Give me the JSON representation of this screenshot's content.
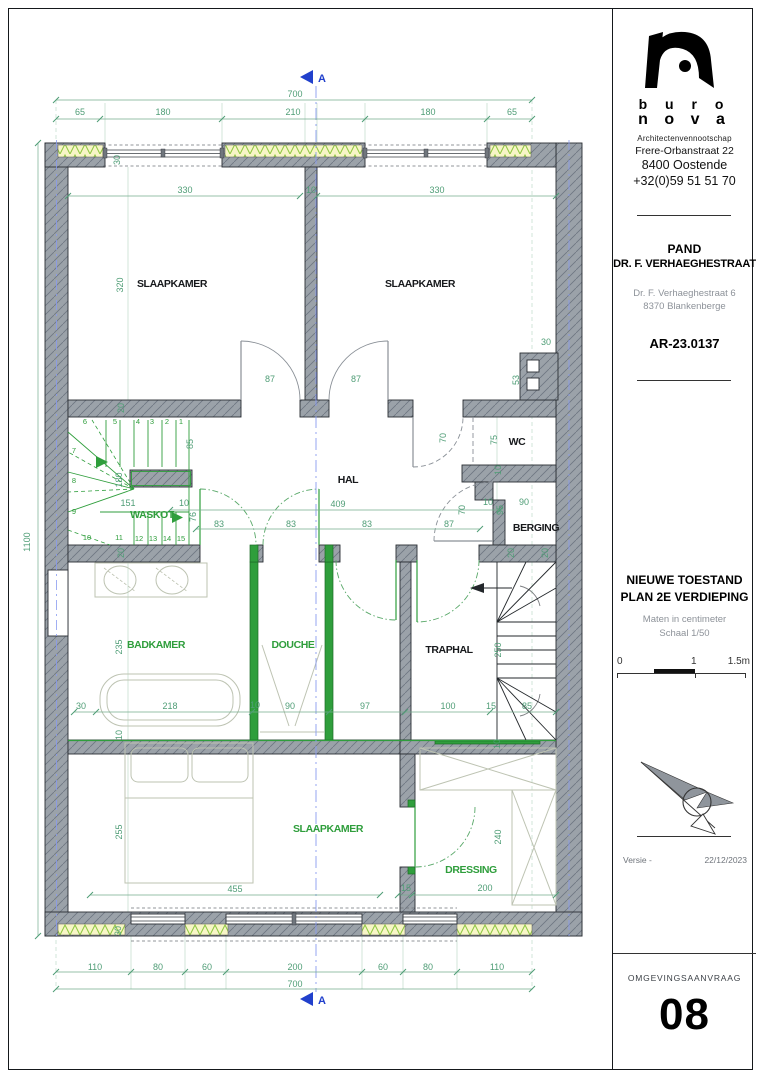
{
  "firm": {
    "logo_word1": "b u r o",
    "logo_word2": "n o v a",
    "descriptor": "Architectenvennootschap",
    "street": "Frere-Orbanstraat 22",
    "city": "8400 Oostende",
    "phone": "+32(0)59 51 51 70"
  },
  "project": {
    "name_line1": "PAND",
    "name_line2": "DR. F. VERHAEGHESTRAAT",
    "address_line1": "Dr. F. Verhaeghestraat 6",
    "address_line2": "8370 Blankenberge",
    "reference": "AR-23.0137"
  },
  "drawing": {
    "title_line1": "NIEUWE TOESTAND",
    "title_line2": "PLAN 2E VERDIEPING",
    "units_note": "Maten in centimeter",
    "scale_note": "Schaal 1/50",
    "scale_bar": {
      "start": "0",
      "mid": "1",
      "end": "1.5m"
    },
    "section_label": "A"
  },
  "sheet": {
    "version_label": "Versie -",
    "version_date": "22/12/2023",
    "doc_type": "OMGEVINGSAANVRAAG",
    "number": "08"
  },
  "colors": {
    "wall_gray": "#9ba2a9",
    "new_work_green": "#2f9e3c",
    "dimension_green": "#4f9d76",
    "insulation_yellow": "#f7f5c6",
    "insulation_zigzag": "#8cc63f",
    "section_blue": "#2140cc",
    "party_wall_blue": "#8a9cf0"
  },
  "plan": {
    "rooms": [
      {
        "label": "SLAAPKAMER",
        "x": 172,
        "y": 287,
        "color": "black"
      },
      {
        "label": "SLAAPKAMER",
        "x": 420,
        "y": 287,
        "color": "black"
      },
      {
        "label": "HAL",
        "x": 348,
        "y": 483,
        "color": "black"
      },
      {
        "label": "WC",
        "x": 517,
        "y": 445,
        "color": "black"
      },
      {
        "label": "BERGING",
        "x": 536,
        "y": 531,
        "color": "black"
      },
      {
        "label": "WASKOT",
        "x": 152,
        "y": 518,
        "color": "green"
      },
      {
        "label": "BADKAMER",
        "x": 156,
        "y": 648,
        "color": "green"
      },
      {
        "label": "DOUCHE",
        "x": 293,
        "y": 648,
        "color": "green"
      },
      {
        "label": "TRAPHAL",
        "x": 449,
        "y": 653,
        "color": "black"
      },
      {
        "label": "SLAAPKAMER",
        "x": 328,
        "y": 832,
        "color": "green"
      },
      {
        "label": "DRESSING",
        "x": 471,
        "y": 873,
        "color": "green"
      }
    ],
    "dims": [
      {
        "t": "700",
        "x": 295,
        "y": 97
      },
      {
        "t": "65",
        "x": 80,
        "y": 115
      },
      {
        "t": "180",
        "x": 163,
        "y": 115
      },
      {
        "t": "210",
        "x": 293,
        "y": 115
      },
      {
        "t": "180",
        "x": 428,
        "y": 115
      },
      {
        "t": "65",
        "x": 512,
        "y": 115
      },
      {
        "t": "330",
        "x": 185,
        "y": 193
      },
      {
        "t": "10",
        "x": 311,
        "y": 193
      },
      {
        "t": "330",
        "x": 437,
        "y": 193
      },
      {
        "t": "30",
        "x": 120,
        "y": 160,
        "r": 1
      },
      {
        "t": "320",
        "x": 123,
        "y": 285,
        "r": 1
      },
      {
        "t": "20",
        "x": 124,
        "y": 408,
        "r": 1
      },
      {
        "t": "30",
        "x": 546,
        "y": 345
      },
      {
        "t": "53",
        "x": 519,
        "y": 380,
        "r": 1
      },
      {
        "t": "87",
        "x": 270,
        "y": 382
      },
      {
        "t": "87",
        "x": 356,
        "y": 382
      },
      {
        "t": "85",
        "x": 193,
        "y": 444,
        "r": 1
      },
      {
        "t": "180",
        "x": 122,
        "y": 480,
        "r": 1
      },
      {
        "t": "151",
        "x": 128,
        "y": 506
      },
      {
        "t": "10",
        "x": 184,
        "y": 506
      },
      {
        "t": "76",
        "x": 196,
        "y": 517,
        "r": 1
      },
      {
        "t": "20",
        "x": 124,
        "y": 553,
        "r": 1
      },
      {
        "t": "409",
        "x": 338,
        "y": 507
      },
      {
        "t": "83",
        "x": 219,
        "y": 527
      },
      {
        "t": "83",
        "x": 291,
        "y": 527
      },
      {
        "t": "83",
        "x": 367,
        "y": 527
      },
      {
        "t": "87",
        "x": 449,
        "y": 527
      },
      {
        "t": "70",
        "x": 446,
        "y": 438,
        "r": 1
      },
      {
        "t": "75",
        "x": 497,
        "y": 440,
        "r": 1
      },
      {
        "t": "10",
        "x": 501,
        "y": 470,
        "r": 1
      },
      {
        "t": "70",
        "x": 465,
        "y": 510,
        "r": 1
      },
      {
        "t": "10",
        "x": 488,
        "y": 505
      },
      {
        "t": "95",
        "x": 503,
        "y": 510,
        "r": 1
      },
      {
        "t": "90",
        "x": 524,
        "y": 505
      },
      {
        "t": "20",
        "x": 548,
        "y": 553,
        "r": 1
      },
      {
        "t": "235",
        "x": 122,
        "y": 647,
        "r": 1
      },
      {
        "t": "30",
        "x": 81,
        "y": 709
      },
      {
        "t": "218",
        "x": 170,
        "y": 709
      },
      {
        "t": "10",
        "x": 255,
        "y": 708
      },
      {
        "t": "90",
        "x": 290,
        "y": 709
      },
      {
        "t": "97",
        "x": 365,
        "y": 709
      },
      {
        "t": "100",
        "x": 448,
        "y": 709
      },
      {
        "t": "15",
        "x": 491,
        "y": 709
      },
      {
        "t": "85",
        "x": 527,
        "y": 709
      },
      {
        "t": "250",
        "x": 501,
        "y": 650,
        "r": 1
      },
      {
        "t": "20",
        "x": 514,
        "y": 553,
        "r": 1
      },
      {
        "t": "10",
        "x": 122,
        "y": 735,
        "r": 1
      },
      {
        "t": "10",
        "x": 500,
        "y": 744,
        "r": 1
      },
      {
        "t": "255",
        "x": 122,
        "y": 832,
        "r": 1
      },
      {
        "t": "240",
        "x": 501,
        "y": 837,
        "r": 1
      },
      {
        "t": "455",
        "x": 235,
        "y": 892
      },
      {
        "t": "15",
        "x": 406,
        "y": 891
      },
      {
        "t": "200",
        "x": 485,
        "y": 891
      },
      {
        "t": "30",
        "x": 121,
        "y": 931,
        "r": 1
      },
      {
        "t": "110",
        "x": 95,
        "y": 970
      },
      {
        "t": "80",
        "x": 158,
        "y": 970
      },
      {
        "t": "60",
        "x": 207,
        "y": 970
      },
      {
        "t": "200",
        "x": 295,
        "y": 970
      },
      {
        "t": "60",
        "x": 383,
        "y": 970
      },
      {
        "t": "80",
        "x": 428,
        "y": 970
      },
      {
        "t": "110",
        "x": 497,
        "y": 970
      },
      {
        "t": "700",
        "x": 295,
        "y": 987
      },
      {
        "t": "1100",
        "x": 30,
        "y": 542,
        "r": 1
      }
    ],
    "stair_numbers": [
      {
        "t": "6",
        "x": 85,
        "y": 424
      },
      {
        "t": "5",
        "x": 115,
        "y": 424
      },
      {
        "t": "4",
        "x": 138,
        "y": 424
      },
      {
        "t": "3",
        "x": 152,
        "y": 424
      },
      {
        "t": "2",
        "x": 167,
        "y": 424
      },
      {
        "t": "1",
        "x": 181,
        "y": 424
      },
      {
        "t": "7",
        "x": 74,
        "y": 453
      },
      {
        "t": "8",
        "x": 74,
        "y": 483
      },
      {
        "t": "9",
        "x": 74,
        "y": 514
      },
      {
        "t": "10",
        "x": 87,
        "y": 540
      },
      {
        "t": "11",
        "x": 119,
        "y": 540
      },
      {
        "t": "12",
        "x": 139,
        "y": 541
      },
      {
        "t": "13",
        "x": 153,
        "y": 541
      },
      {
        "t": "14",
        "x": 167,
        "y": 541
      },
      {
        "t": "15",
        "x": 181,
        "y": 541
      }
    ]
  }
}
